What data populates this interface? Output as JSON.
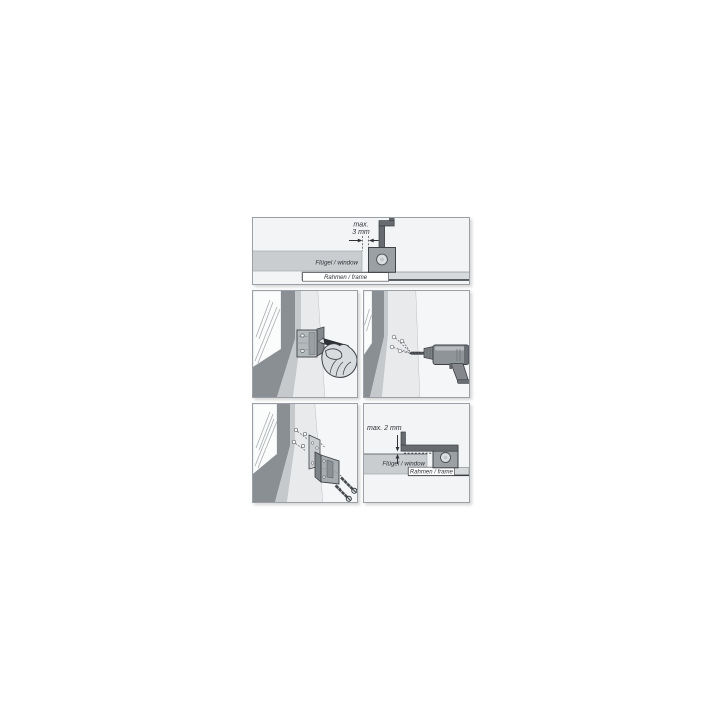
{
  "figure": {
    "panels": {
      "side_gap": {
        "measurement_line1": "max.",
        "measurement_line2": "3 mm",
        "sash_label": "Flügel / window",
        "frame_label": "Rahmen / frame"
      },
      "mark_holes": {
        "icons": [
          "window-corner-icon",
          "mounting-bracket-icon",
          "pencil-icon",
          "hand-icon"
        ]
      },
      "drill_holes": {
        "icons": [
          "window-corner-icon",
          "drill-marks-icon",
          "drill-icon"
        ]
      },
      "screw_mounting": {
        "icons": [
          "window-corner-icon",
          "drilled-holes-icon",
          "mounting-plate-icon",
          "contact-device-icon",
          "screws-icon"
        ]
      },
      "top_gap": {
        "measurement": "max. 2 mm",
        "sash_label": "Flügel / window",
        "frame_label": "Rahmen / frame"
      }
    },
    "palette": {
      "page_bg": "#ffffff",
      "panel_bg": "#f3f4f6",
      "panel_border": "#9aa0a5",
      "sash_fill": "#c9cdd0",
      "frame_fill": "#d7dadb",
      "device_block": "#9ba0a4",
      "device_arm": "#686c70",
      "band_dark": "#8a8f93",
      "band_mid": "#c5c9cb",
      "frame_face": "#e8eaec",
      "glass": "#fbfcfc",
      "outline": "#3a3e42",
      "label_text": "#2e3236"
    }
  }
}
